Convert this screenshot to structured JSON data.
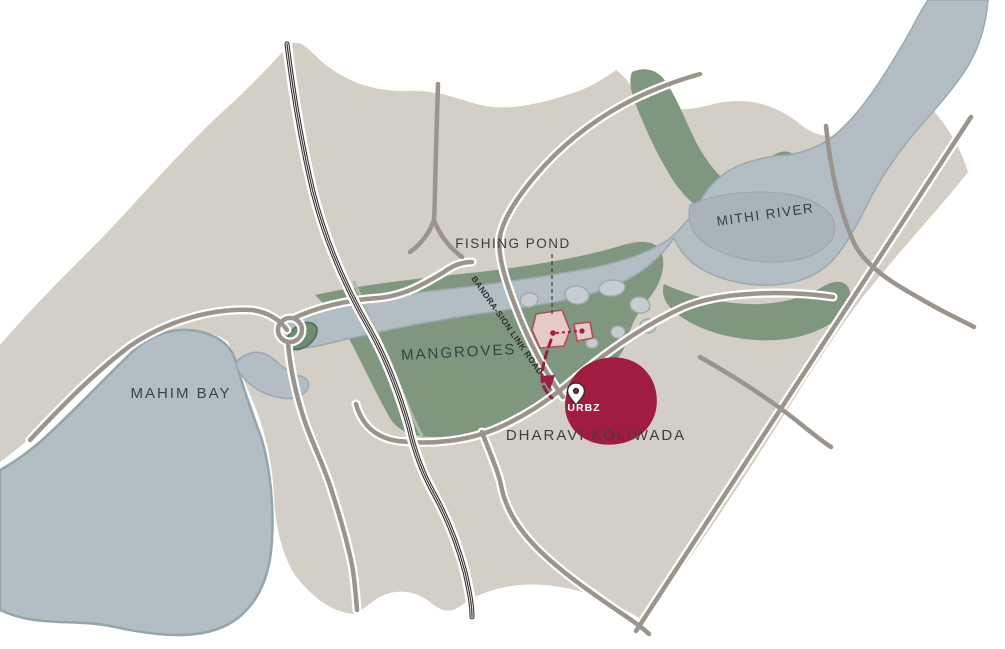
{
  "map": {
    "labels": {
      "fishing_pond": "FISHING POND",
      "mangroves": "MANGROVES",
      "mahim_bay": "MAHIM BAY",
      "mithi_river": "MITHI RIVER",
      "bandra_sion_link_road": "BANDRA-SION LINK ROAD",
      "urbz": "URBZ",
      "dharavi_koliwada": "DHARAVI KOLIWADA"
    },
    "colors": {
      "land": "#D3CEC6",
      "water": "#B2BDC4",
      "water_outline": "#95A5AC",
      "water_dark_patch": "#A9B3BA",
      "mangrove_green": "#7E977E",
      "green_pond": "#6E8C70",
      "green_pond_outline": "#4F7055",
      "fishing_pond_fill": "#C6CDD0",
      "road_gray": "#9A948C",
      "road_pale": "#B4B7AE",
      "railway_dark": "#3B3330",
      "urbz_red": "#A01D40",
      "building_pink": "#E6CAC7",
      "building_outline": "#AF5058",
      "label_dark": "#3E3E3E",
      "label_green": "#344440",
      "label_water": "#3A424C",
      "label_white": "#FFFFFF"
    }
  }
}
